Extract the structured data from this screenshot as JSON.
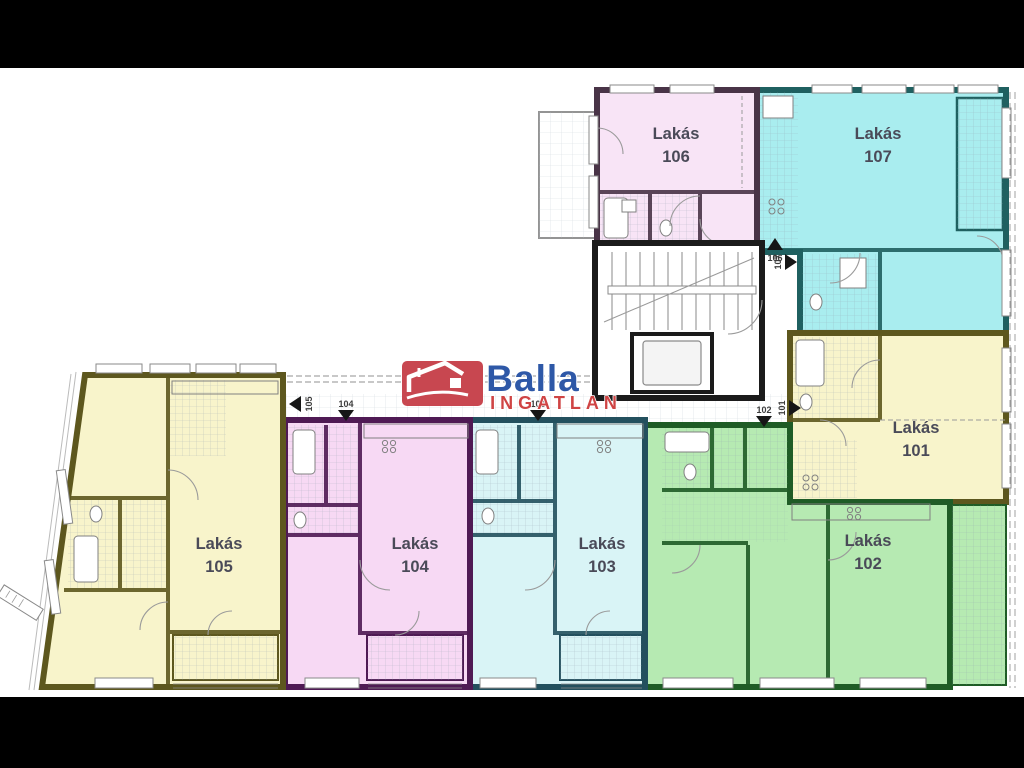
{
  "page": {
    "letterbox_color": "#000000",
    "canvas_color": "#ffffff"
  },
  "labels": {
    "color": "#4a4a58"
  },
  "apartments": [
    {
      "name": "Lakás",
      "number": "101",
      "fill": "#f8f4cb",
      "wall": "#5d571e"
    },
    {
      "name": "Lakás",
      "number": "102",
      "fill": "#b6eab2",
      "wall": "#1f5c26"
    },
    {
      "name": "Lakás",
      "number": "103",
      "fill": "#d9f4f6",
      "wall": "#23505e"
    },
    {
      "name": "Lakás",
      "number": "104",
      "fill": "#f7d9f4",
      "wall": "#4f1a54"
    },
    {
      "name": "Lakás",
      "number": "105",
      "fill": "#f8f4cb",
      "wall": "#5d571e"
    },
    {
      "name": "Lakás",
      "number": "106",
      "fill": "#f8e4f6",
      "wall": "#493447"
    },
    {
      "name": "Lakás",
      "number": "107",
      "fill": "#a9edef",
      "wall": "#1f6060"
    }
  ],
  "entrances": [
    {
      "number": "101"
    },
    {
      "number": "102"
    },
    {
      "number": "103"
    },
    {
      "number": "104"
    },
    {
      "number": "105"
    },
    {
      "number": "106"
    },
    {
      "number": "107"
    }
  ],
  "logo": {
    "brand": "Balla",
    "subtitle": "INGATLAN",
    "brand_color": "#2e58a7",
    "subtitle_color": "#cf4444",
    "badge_color": "#c84750",
    "badge_glyph_color": "#ffffff"
  },
  "core": {
    "wall_color": "#1b1b1b"
  }
}
